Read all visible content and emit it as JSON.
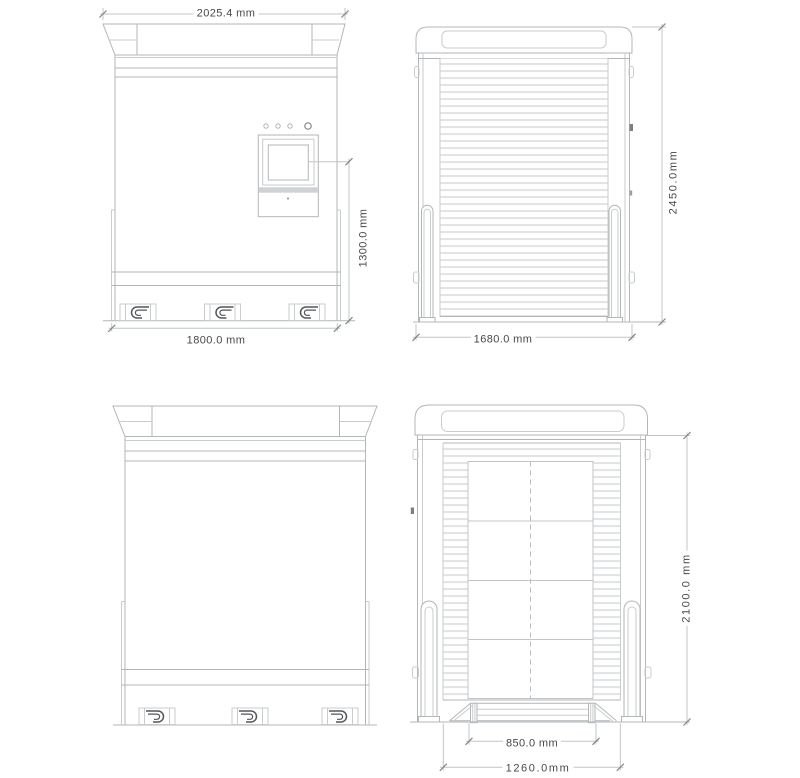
{
  "palette": {
    "line_main": "#b2b6b8",
    "line_light": "#c9cccd",
    "dimension_line": "#c2c5c7",
    "text": "#45484b",
    "dark_detail": "#53565a"
  },
  "views": {
    "front": {
      "dims": {
        "top_width": "2025.4 mm",
        "control_panel_height": "1300.0 mm",
        "bottom_width": "1800.0 mm"
      }
    },
    "side_closed": {
      "dims": {
        "height": "2450.0mm",
        "bottom_width": "1680.0 mm"
      }
    },
    "rear": {
      "dims": {}
    },
    "side_open": {
      "dims": {
        "height": "2100.0 mm",
        "pallet_width": "850.0 mm",
        "opening_width": "1260.0mm"
      }
    }
  }
}
